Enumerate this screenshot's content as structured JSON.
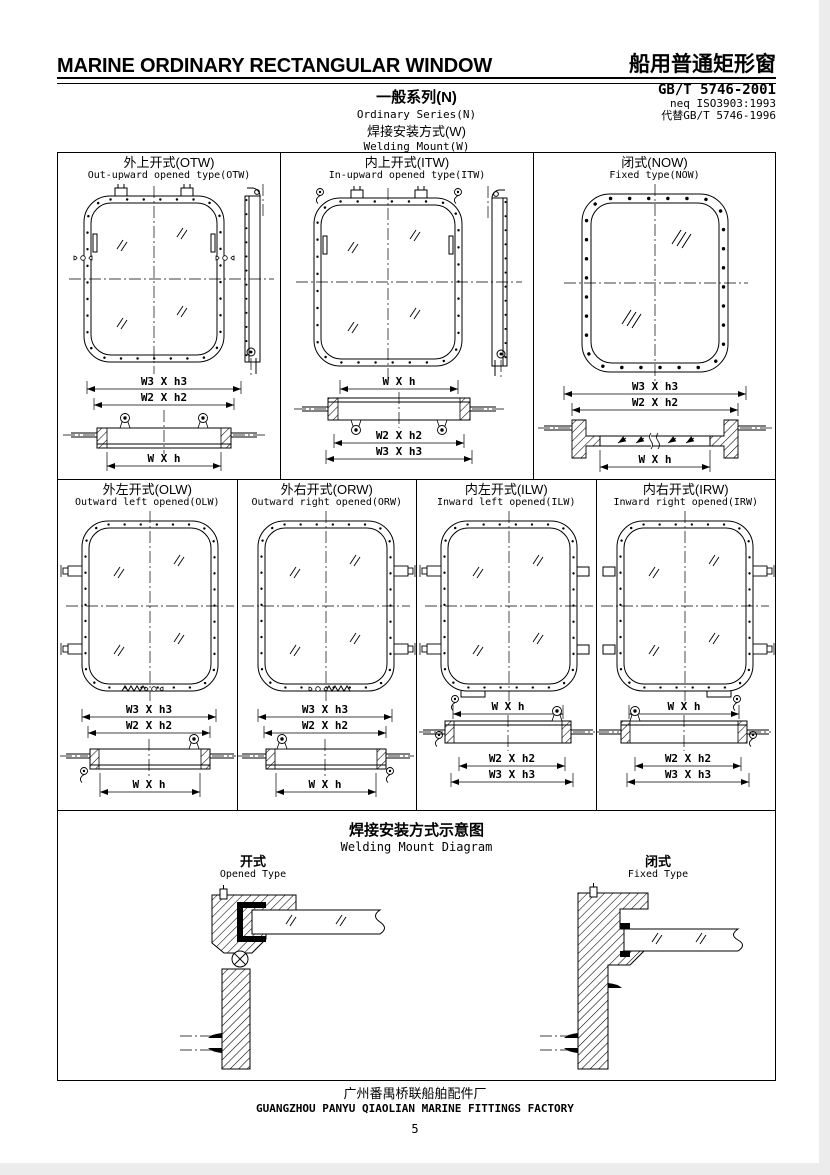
{
  "header": {
    "title_en": "MARINE ORDINARY RECTANGULAR WINDOW",
    "title_zh": "船用普通矩形窗",
    "standard_code": "GB/T 5746-2001",
    "standard_neq": "neq ISO3903:1993",
    "standard_replaces": "代替GB/T 5746-1996",
    "series_zh": "一般系列(N)",
    "series_en": "Ordinary Series(N)",
    "mount_zh": "焊接安装方式(W)",
    "mount_en": "Welding Mount(W)"
  },
  "dims": {
    "w3h3": "W3 X h3",
    "w2h2": "W2 X h2",
    "wh": "W X h"
  },
  "cells": [
    {
      "zh": "外上开式(OTW)",
      "en": "Out-upward opened type(OTW)"
    },
    {
      "zh": "内上开式(ITW)",
      "en": "In-upward opened type(ITW)"
    },
    {
      "zh": "闭式(NOW)",
      "en": "Fixed type(NOW)"
    },
    {
      "zh": "外左开式(OLW)",
      "en": "Outward left opened(OLW)"
    },
    {
      "zh": "外右开式(ORW)",
      "en": "Outward right opened(ORW)"
    },
    {
      "zh": "内左开式(ILW)",
      "en": "Inward left opened(ILW)"
    },
    {
      "zh": "内右开式(IRW)",
      "en": "Inward right opened(IRW)"
    }
  ],
  "welding": {
    "title_zh": "焊接安装方式示意图",
    "title_en": "Welding Mount Diagram",
    "opened_zh": "开式",
    "opened_en": "Opened Type",
    "fixed_zh": "闭式",
    "fixed_en": "Fixed Type"
  },
  "footer": {
    "factory_zh": "广州番禺桥联船舶配件厂",
    "factory_en": "GUANGZHOU PANYU QIAOLIAN MARINE FITTINGS FACTORY",
    "page_number": "5"
  }
}
